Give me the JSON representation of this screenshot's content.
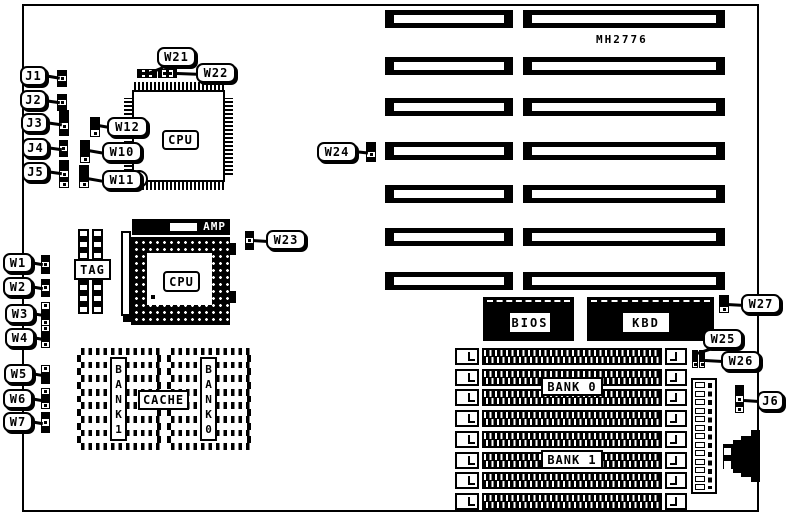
{
  "board": {
    "part_number": "MH2776"
  },
  "labels": {
    "cpu_qfp": "CPU",
    "cpu_pga": "CPU",
    "amp": "AMP",
    "tag": "TAG",
    "cache": "CACHE",
    "bank1_vertical": "BANK1",
    "bank0_vertical": "BANK0",
    "bios": "BIOS",
    "kbd": "KBD",
    "simm_bank0": "BANK 0",
    "simm_bank1": "BANK 1"
  },
  "callouts": [
    {
      "id": "J1",
      "label": "J1",
      "x": 20,
      "y": 66,
      "w": 27,
      "h": 20,
      "tail": {
        "x": 44,
        "y": 74,
        "len": 16,
        "angle": 10
      }
    },
    {
      "id": "J2",
      "label": "J2",
      "x": 20,
      "y": 90,
      "w": 27,
      "h": 20,
      "tail": {
        "x": 44,
        "y": 99,
        "len": 16,
        "angle": 8
      }
    },
    {
      "id": "J3",
      "label": "J3",
      "x": 21,
      "y": 113,
      "w": 27,
      "h": 20,
      "tail": {
        "x": 45,
        "y": 121,
        "len": 17,
        "angle": 8
      }
    },
    {
      "id": "J4",
      "label": "J4",
      "x": 22,
      "y": 138,
      "w": 27,
      "h": 20,
      "tail": {
        "x": 46,
        "y": 146,
        "len": 16,
        "angle": 8
      }
    },
    {
      "id": "J5",
      "label": "J5",
      "x": 22,
      "y": 162,
      "w": 27,
      "h": 20,
      "tail": {
        "x": 46,
        "y": 170,
        "len": 16,
        "angle": 8
      }
    },
    {
      "id": "W21",
      "label": "W21",
      "x": 157,
      "y": 47,
      "w": 39,
      "h": 20,
      "tail": {
        "x": 146,
        "y": 73,
        "len": 18,
        "angle": -22
      }
    },
    {
      "id": "W22",
      "label": "W22",
      "x": 196,
      "y": 63,
      "w": 40,
      "h": 20,
      "tail": {
        "x": 177,
        "y": 72,
        "len": 20,
        "angle": 2
      }
    },
    {
      "id": "W12",
      "label": "W12",
      "x": 107,
      "y": 117,
      "w": 41,
      "h": 20,
      "tail": {
        "x": 98,
        "y": 124,
        "len": 11,
        "angle": 10
      }
    },
    {
      "id": "W10",
      "label": "W10",
      "x": 102,
      "y": 142,
      "w": 40,
      "h": 20,
      "tail": {
        "x": 88,
        "y": 149,
        "len": 16,
        "angle": 10
      }
    },
    {
      "id": "W11",
      "label": "W11",
      "x": 102,
      "y": 170,
      "w": 40,
      "h": 20,
      "tail": {
        "x": 87,
        "y": 177,
        "len": 17,
        "angle": 10
      }
    },
    {
      "id": "W24",
      "label": "W24",
      "x": 317,
      "y": 142,
      "w": 40,
      "h": 20,
      "tail": {
        "x": 354,
        "y": 150,
        "len": 14,
        "angle": 6
      }
    },
    {
      "id": "W23",
      "label": "W23",
      "x": 266,
      "y": 230,
      "w": 40,
      "h": 20,
      "tail": {
        "x": 253,
        "y": 239,
        "len": 15,
        "angle": 4
      }
    },
    {
      "id": "W1",
      "label": "W1",
      "x": 3,
      "y": 253,
      "w": 30,
      "h": 20,
      "tail": {
        "x": 30,
        "y": 261,
        "len": 13,
        "angle": 10
      }
    },
    {
      "id": "W2",
      "label": "W2",
      "x": 3,
      "y": 277,
      "w": 30,
      "h": 20,
      "tail": {
        "x": 30,
        "y": 285,
        "len": 13,
        "angle": 10
      }
    },
    {
      "id": "W3",
      "label": "W3",
      "x": 5,
      "y": 304,
      "w": 30,
      "h": 20,
      "tail": {
        "x": 32,
        "y": 312,
        "len": 12,
        "angle": 10
      }
    },
    {
      "id": "W4",
      "label": "W4",
      "x": 5,
      "y": 328,
      "w": 30,
      "h": 20,
      "tail": {
        "x": 32,
        "y": 336,
        "len": 11,
        "angle": 10
      }
    },
    {
      "id": "W5",
      "label": "W5",
      "x": 4,
      "y": 364,
      "w": 30,
      "h": 20,
      "tail": {
        "x": 31,
        "y": 372,
        "len": 12,
        "angle": 10
      }
    },
    {
      "id": "W6",
      "label": "W6",
      "x": 3,
      "y": 389,
      "w": 30,
      "h": 20,
      "tail": {
        "x": 30,
        "y": 397,
        "len": 13,
        "angle": 10
      }
    },
    {
      "id": "W7",
      "label": "W7",
      "x": 3,
      "y": 412,
      "w": 30,
      "h": 20,
      "tail": {
        "x": 30,
        "y": 420,
        "len": 13,
        "angle": 10
      }
    },
    {
      "id": "W27",
      "label": "W27",
      "x": 741,
      "y": 294,
      "w": 40,
      "h": 20,
      "tail": {
        "x": 727,
        "y": 303,
        "len": 16,
        "angle": 3
      }
    },
    {
      "id": "W25",
      "label": "W25",
      "x": 703,
      "y": 329,
      "w": 40,
      "h": 20,
      "tail": {
        "x": 697,
        "y": 352,
        "len": 14,
        "angle": -18
      }
    },
    {
      "id": "W26",
      "label": "W26",
      "x": 721,
      "y": 351,
      "w": 40,
      "h": 20,
      "tail": {
        "x": 705,
        "y": 359,
        "len": 18,
        "angle": 3
      }
    },
    {
      "id": "J6",
      "label": "J6",
      "x": 757,
      "y": 391,
      "w": 27,
      "h": 20,
      "tail": {
        "x": 744,
        "y": 399,
        "len": 15,
        "angle": 4
      }
    }
  ],
  "jumpers": [
    {
      "id": "J1-header",
      "x": 57,
      "y": 70,
      "w": 10,
      "h": 17,
      "dir": "v",
      "cells": "101"
    },
    {
      "id": "J2-header",
      "x": 57,
      "y": 94,
      "w": 10,
      "h": 17,
      "dir": "v",
      "cells": "101"
    },
    {
      "id": "J3-header",
      "x": 59,
      "y": 110,
      "w": 10,
      "h": 26,
      "dir": "v",
      "cells": "1101"
    },
    {
      "id": "J4-header",
      "x": 59,
      "y": 140,
      "w": 9,
      "h": 17,
      "dir": "v",
      "cells": "101"
    },
    {
      "id": "J5-header",
      "x": 59,
      "y": 160,
      "w": 10,
      "h": 28,
      "dir": "v",
      "cells": "11010"
    },
    {
      "id": "W12-header",
      "x": 90,
      "y": 117,
      "w": 10,
      "h": 20,
      "dir": "v",
      "cells": "110"
    },
    {
      "id": "W10-header",
      "x": 80,
      "y": 140,
      "w": 10,
      "h": 23,
      "dir": "v",
      "cells": "1110"
    },
    {
      "id": "W11-header",
      "x": 79,
      "y": 165,
      "w": 10,
      "h": 23,
      "dir": "v",
      "cells": "1110"
    },
    {
      "id": "W21-header",
      "x": 137,
      "y": 69,
      "w": 20,
      "h": 9,
      "dir": "h",
      "cells": "10101"
    },
    {
      "id": "W22-header",
      "x": 158,
      "y": 69,
      "w": 19,
      "h": 9,
      "dir": "h",
      "cells": "10101"
    },
    {
      "id": "W23-header",
      "x": 245,
      "y": 231,
      "w": 9,
      "h": 19,
      "dir": "v",
      "cells": "101"
    },
    {
      "id": "W24-header",
      "x": 366,
      "y": 142,
      "w": 10,
      "h": 20,
      "dir": "v",
      "cells": "1101"
    },
    {
      "id": "W1-header",
      "x": 41,
      "y": 255,
      "w": 9,
      "h": 19,
      "dir": "v",
      "cells": "101"
    },
    {
      "id": "W2-header",
      "x": 41,
      "y": 279,
      "w": 9,
      "h": 18,
      "dir": "v",
      "cells": "101"
    },
    {
      "id": "W3-header",
      "x": 41,
      "y": 302,
      "w": 9,
      "h": 24,
      "dir": "v",
      "cells": "0110"
    },
    {
      "id": "W4-header",
      "x": 41,
      "y": 325,
      "w": 9,
      "h": 23,
      "dir": "v",
      "cells": "0110"
    },
    {
      "id": "W5-header",
      "x": 41,
      "y": 365,
      "w": 9,
      "h": 19,
      "dir": "v",
      "cells": "011"
    },
    {
      "id": "W6-header",
      "x": 41,
      "y": 388,
      "w": 9,
      "h": 21,
      "dir": "v",
      "cells": "0110"
    },
    {
      "id": "W7-header",
      "x": 41,
      "y": 412,
      "w": 9,
      "h": 21,
      "dir": "v",
      "cells": "101"
    },
    {
      "id": "W25-header",
      "x": 692,
      "y": 350,
      "w": 6,
      "h": 18,
      "dir": "v",
      "cells": "110"
    },
    {
      "id": "W26-header",
      "x": 699,
      "y": 350,
      "w": 6,
      "h": 18,
      "dir": "v",
      "cells": "110"
    },
    {
      "id": "W27-header",
      "x": 719,
      "y": 295,
      "w": 10,
      "h": 18,
      "dir": "v",
      "cells": "110"
    },
    {
      "id": "J6-header",
      "x": 735,
      "y": 385,
      "w": 9,
      "h": 28,
      "dir": "v",
      "cells": "11010"
    }
  ],
  "expansion_slots": {
    "columns": [
      {
        "x": 385,
        "width": 128
      },
      {
        "x": 523,
        "width": 202
      }
    ],
    "row_ys": [
      10,
      57,
      98,
      142,
      185,
      228,
      272
    ],
    "height": 18
  },
  "simm_sockets": {
    "x": 455,
    "width": 232,
    "height": 17,
    "row_ys": [
      348,
      369,
      389,
      410,
      431,
      452,
      472,
      493
    ]
  },
  "tag_chip": {
    "columns": 2,
    "pads_per_column": 8
  },
  "cache_blocks": {
    "blocks": 2,
    "pad_rows": 8,
    "chip_bars": 7
  },
  "power_connector": {
    "pin_squares": 13
  }
}
